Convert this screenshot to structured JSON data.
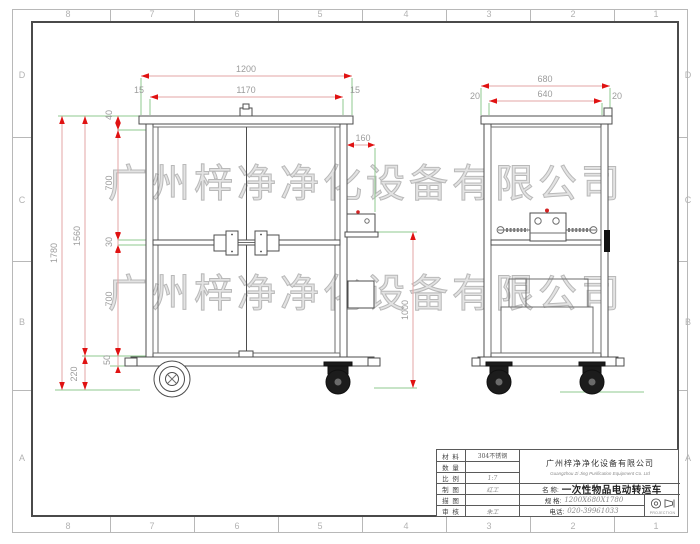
{
  "border": {
    "cols": [
      "8",
      "7",
      "6",
      "5",
      "4",
      "3",
      "2",
      "1"
    ],
    "rows": [
      "D",
      "C",
      "B",
      "A"
    ]
  },
  "watermark": {
    "text": "广州梓净净化设备有限公司"
  },
  "drawing": {
    "front_dims": {
      "overall_width": "1200",
      "inner_width": "1170",
      "edge_left": "15",
      "edge_right": "15",
      "overall_height": "1780",
      "body_height": "1560",
      "caster_height": "220",
      "top_rail": "40",
      "upper_panel": "700",
      "mid_shelf": "30",
      "lower_panel": "700",
      "base_rail": "50",
      "control_box_width": "160",
      "push_height": "1000"
    },
    "side_dims": {
      "overall_depth": "680",
      "inner_depth": "640",
      "edge_left": "20",
      "edge_right": "20"
    }
  },
  "title_block": {
    "info_rows": [
      {
        "label": "材 料",
        "value": "304不锈钢"
      },
      {
        "label": "数 量",
        "value": ""
      },
      {
        "label": "比 例",
        "value": "1:7"
      },
      {
        "label": "制 图",
        "value": "红工"
      },
      {
        "label": "描 图",
        "value": ""
      },
      {
        "label": "审 核",
        "value": "朱工"
      }
    ],
    "company_cn": "广州梓净净化设备有限公司",
    "company_en": "Guangzhou Zi Jing Purification Equipment Co. Ltd",
    "name_label": "名 称:",
    "name_value": "一次性物品电动转运车",
    "spec_label": "规 格:",
    "spec_value": "1200X680X1780",
    "phone_label": "电话:",
    "phone_value": "020-39961033",
    "projection": "PROJECTION"
  }
}
